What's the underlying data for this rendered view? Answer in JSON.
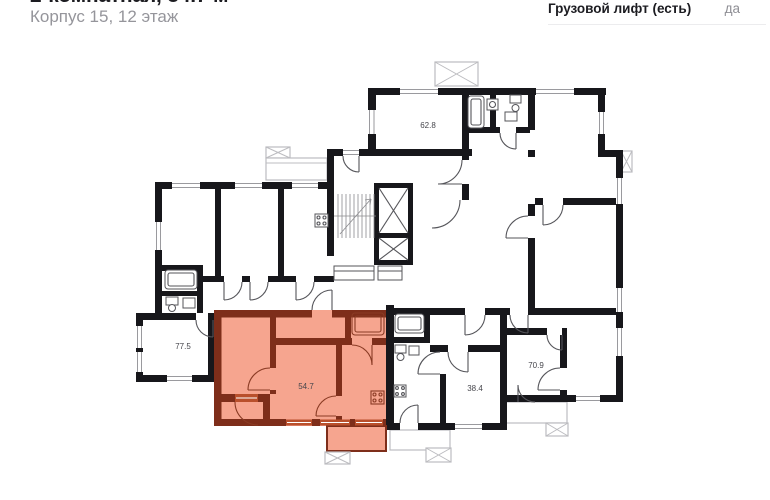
{
  "header": {
    "title": "2-комнатная, 54.7 м²",
    "subtitle": "Корпус 15, 12 этаж"
  },
  "specs": {
    "label": "Грузовой лифт (есть)",
    "value": "да"
  },
  "plan": {
    "highlighted_area": "54.7",
    "labels": {
      "apt_top": "62.8",
      "apt_left": "77.5",
      "apt_selected": "54.7",
      "apt_bottom_mid": "38.4",
      "apt_bottom_right": "70.9"
    },
    "colors": {
      "wall": "#17171b",
      "highlight_fill": "#f6a58f",
      "highlight_wall": "#7e2e1a",
      "highlight_door": "#b9502c"
    }
  }
}
